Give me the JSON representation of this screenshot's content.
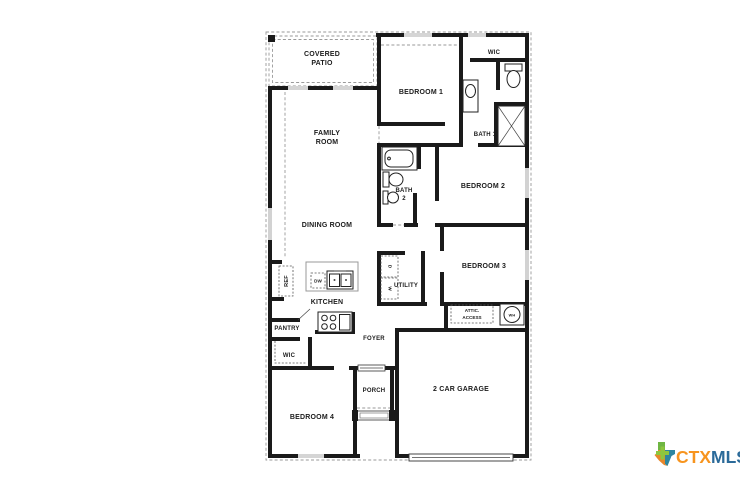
{
  "plan": {
    "labels": {
      "covered_patio": {
        "l1": "COVERED",
        "l2": "PATIO"
      },
      "bedroom1": "BEDROOM 1",
      "wic1": "WIC",
      "bath1": "BATH 1",
      "family": {
        "l1": "FAMILY",
        "l2": "ROOM"
      },
      "bath2": {
        "l1": "BATH",
        "l2": "2"
      },
      "bedroom2": "BEDROOM 2",
      "dining": "DINING ROOM",
      "bedroom3": "BEDROOM 3",
      "utility": "UTILITY",
      "kitchen": "KITCHEN",
      "ref": "REF",
      "pantry": "PANTRY",
      "wic2": "WIC",
      "foyer": "FOYER",
      "attic": {
        "l1": "ATTIC.",
        "l2": "ACCESS"
      },
      "porch": "PORCH",
      "garage": "2 CAR GARAGE",
      "bedroom4": "BEDROOM 4"
    },
    "fixtures": {
      "dishwasher": "DW",
      "dryer": "D",
      "washer": "W",
      "water_heater": "WH"
    },
    "wall_color": "#1a1a1a"
  },
  "watermark": {
    "ctx": "CTX",
    "mls": "MLS",
    "colors": {
      "ctx_orange": "#F7941E",
      "mls_blue": "#2B6A99",
      "texas_green": "#6FB643",
      "texas_teal": "#2E86A0",
      "texas_orange": "#E8872B",
      "plus_green": "#8DC63F"
    }
  }
}
